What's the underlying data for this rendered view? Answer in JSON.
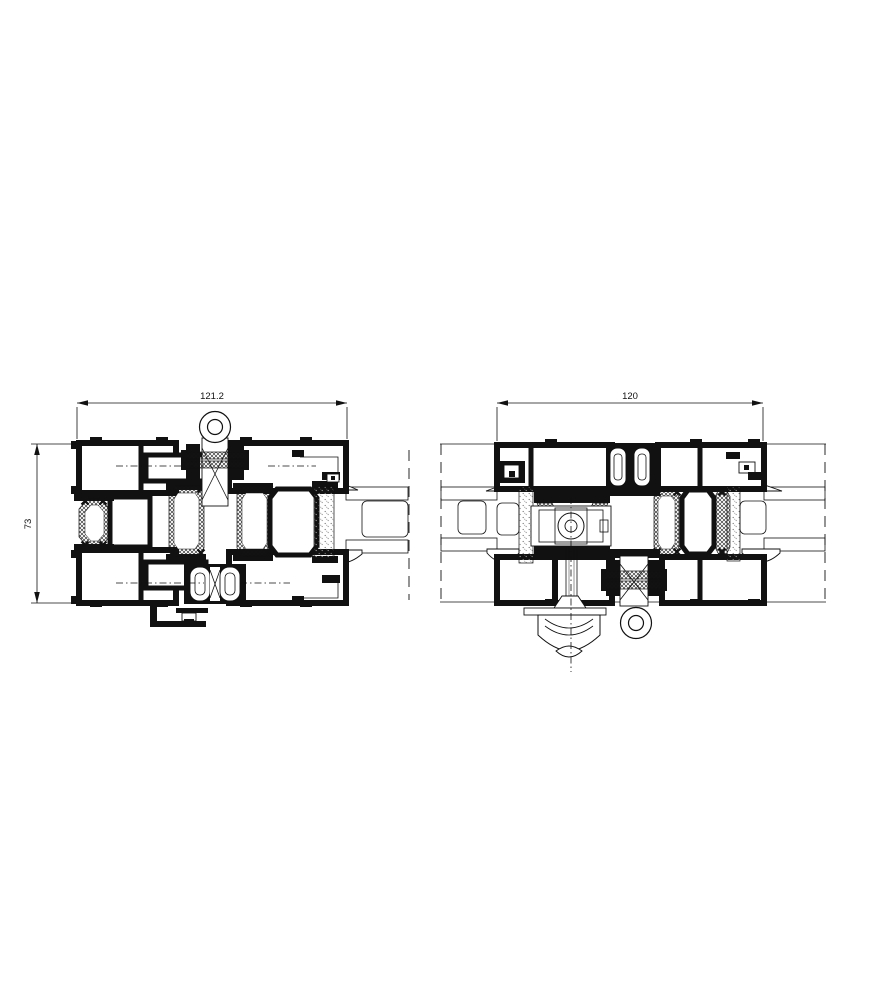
{
  "colors": {
    "line": "#111111",
    "background": "#ffffff",
    "stipple_dot": "#777777"
  },
  "dimensions": {
    "left_section_width": "121.2",
    "left_section_height": "73",
    "right_section_width": "120"
  }
}
